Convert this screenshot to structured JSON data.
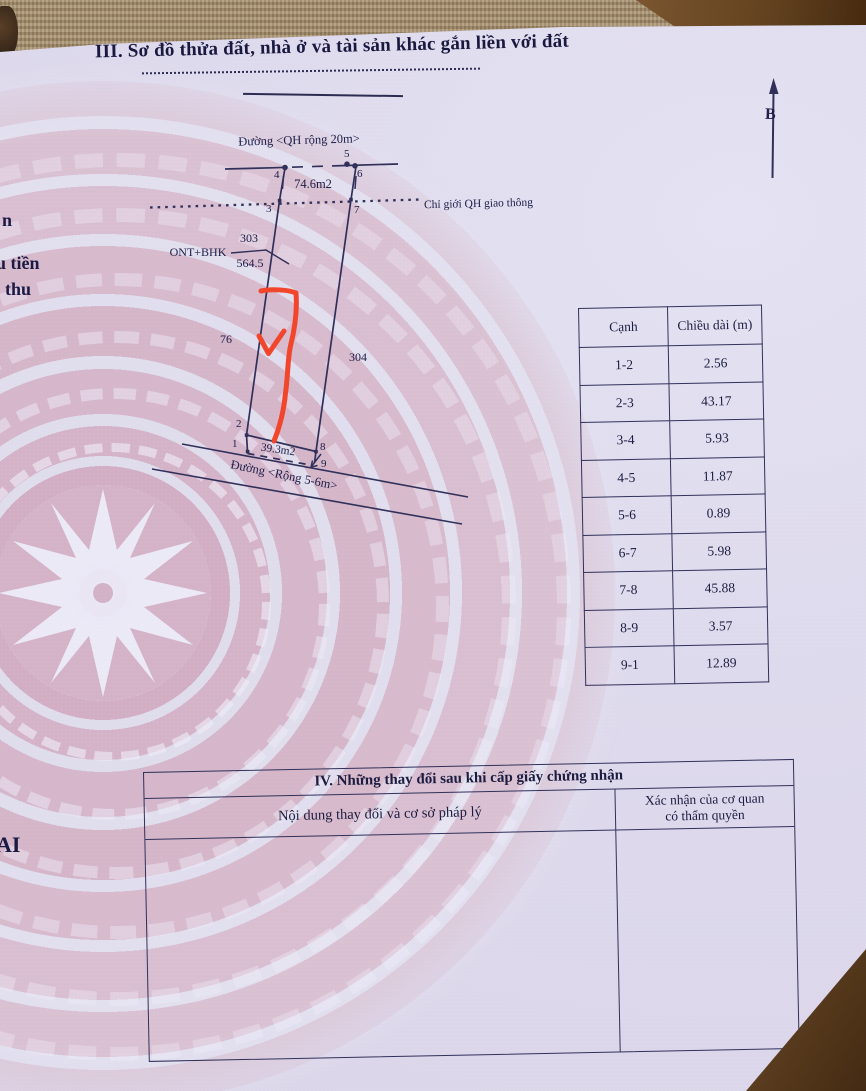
{
  "page": {
    "section3_title": "III. Sơ đồ thửa đất, nhà ở và tài sản khác gắn liền với đất"
  },
  "margin_fragments": {
    "f1": "n",
    "f2": "u tiền",
    "f3": "thu",
    "f4": "AI"
  },
  "diagram": {
    "north_label": "B",
    "road_top_label": "Đường <QH rộng 20m>",
    "road_bottom_label": "Đường <Rộng 5-6m>",
    "planning_boundary_label": "Chỉ giới QH giao thông",
    "area_top": "74.6m2",
    "area_bottom": "39.3m2",
    "plot_number": "303",
    "plot_area": "564.5",
    "land_use_code": "ONT+BHK",
    "neighbor_left": "76",
    "neighbor_right": "304",
    "vertices": [
      "1",
      "2",
      "3",
      "4",
      "5",
      "6",
      "7",
      "8",
      "9"
    ]
  },
  "edge_table": {
    "headers": [
      "Cạnh",
      "Chiều dài (m)"
    ],
    "rows": [
      [
        "1-2",
        "2.56"
      ],
      [
        "2-3",
        "43.17"
      ],
      [
        "3-4",
        "5.93"
      ],
      [
        "4-5",
        "11.87"
      ],
      [
        "5-6",
        "0.89"
      ],
      [
        "6-7",
        "5.98"
      ],
      [
        "7-8",
        "45.88"
      ],
      [
        "8-9",
        "3.57"
      ],
      [
        "9-1",
        "12.89"
      ]
    ]
  },
  "section4": {
    "title": "IV. Những thay đổi sau khi cấp giấy chứng nhận",
    "col1_header": "Nội dung thay đổi và cơ sở pháp lý",
    "col2_header_line1": "Xác nhận của cơ quan",
    "col2_header_line2": "có thẩm quyền"
  },
  "colors": {
    "accent_red_mark": "#f2462c",
    "ink": "#20204a",
    "paper": "#dcd7ea",
    "pink_ring": "#d5b6ca",
    "background_mat": "#a79070"
  }
}
